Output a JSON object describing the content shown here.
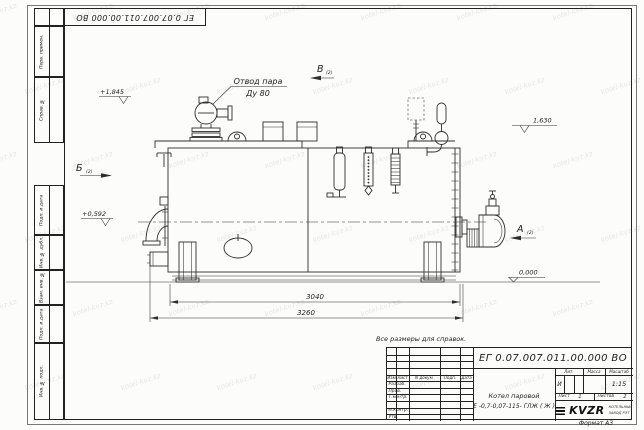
{
  "watermark": {
    "text": "kotel-kvz.kz"
  },
  "sheet": {
    "doc_number_top": "ЕГ 0.07.007.011.00.000  ВО",
    "format_label": "Формат А3",
    "margin_labels": [
      "Перв. примен.",
      "Справ. №",
      "Подп. и дата",
      "Инв. № дубл.",
      "Взам. инв. №",
      "Подп. и дата",
      "Инв. № подл."
    ]
  },
  "drawing": {
    "callout_line1": "Отвод пара",
    "callout_line2": "Ду 80",
    "note": "Все размеры для справок.",
    "view_a": "А",
    "view_b": "Б",
    "view_v": "В",
    "view_ref": "(2)",
    "elev_top_front": "+1,845",
    "elev_mid": "+0,592",
    "elev_top_rear": "1,630",
    "elev_ground": "0,000",
    "dim_shell_length": "3040",
    "dim_overall_length": "3260"
  },
  "title_block": {
    "doc_number": "ЕГ 0.07.007.011.00.000  ВО",
    "name_line1": "Котел паровой",
    "name_line2": "Е -0,7-0,07-115- ГЛЖ ( Ж )",
    "cols": [
      "Изм",
      "Лист",
      "N докум.",
      "Подп.",
      "Дата"
    ],
    "sign_rows": [
      "Разраб.",
      "Пров.",
      "Т.контр.",
      "",
      "Н.контр.",
      "Утв."
    ],
    "lit_label": "Лит.",
    "mass_label": "Масса",
    "scale_label": "Масштаб",
    "lit_value": "И",
    "scale_value": "1:15",
    "sheet_label": "Лист",
    "sheet_value": "1",
    "sheets_label": "Листов",
    "sheets_value": "2",
    "logo_text": "KVZR",
    "company_line1": "КОТЕЛЬНЫЙ",
    "company_line2": "ЗАВОД РЭТ"
  }
}
